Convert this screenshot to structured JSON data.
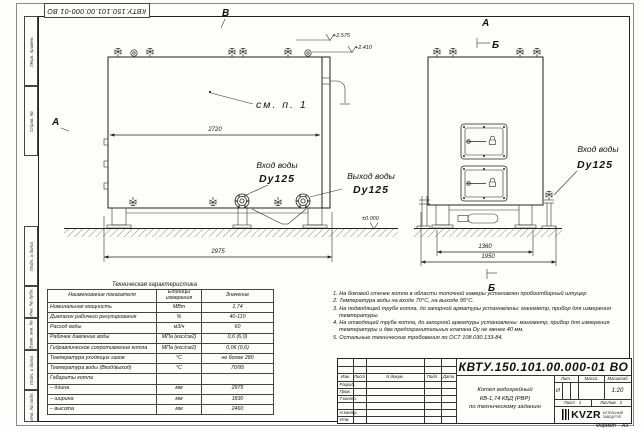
{
  "sheet": {
    "top_stamp": "КВТУ.150.101.00.000-01 ВО",
    "format_label": "Формат",
    "format_value": "А3"
  },
  "margin": {
    "fields": [
      "Перв. примен.",
      "Справ. №",
      "Подп. и дата",
      "Инв. № дубл.",
      "Взам. инв. №",
      "Подп. и дата",
      "Инв. № подл."
    ]
  },
  "views": {
    "front": {
      "mark_top": "В",
      "mark_left": "А",
      "see_note": "см. п. 1",
      "dim_width": "2720",
      "dim_length": "2975",
      "elev1": "+2.575",
      "elev2": "+2.410",
      "elev0": "±0.000",
      "inlet_label": "Вход воды",
      "inlet_dn": "Dy125",
      "outlet_label": "Выход воды",
      "outlet_dn": "Dy125"
    },
    "side": {
      "mark_top": "А",
      "mark_section": "Б",
      "mark_bottom": "Б",
      "dim_inner": "1360",
      "dim_outer": "1950",
      "inlet_label": "Вход воды",
      "inlet_dn": "Dy125"
    }
  },
  "spec_table": {
    "title": "Техническая характеристика",
    "headers": [
      "Наименование показателя",
      "Единицы измерения",
      "Значение"
    ],
    "rows": [
      {
        "name": "Номинальная мощность",
        "unit": "МВт",
        "value": "1,74"
      },
      {
        "name": "Диапазон рабочего регулирования",
        "unit": "%",
        "value": "40-110"
      },
      {
        "name": "Расход воды",
        "unit": "м3/ч",
        "value": "60"
      },
      {
        "name": "Рабочее давление воды",
        "unit": "МПа (кгс/см2)",
        "value": "0,6 (6,0)"
      },
      {
        "name": "Гидравлическое сопротивление котла",
        "unit": "МПа (кгс/см2)",
        "value": "0,06 (0,6)"
      },
      {
        "name": "Температура уходящих газов",
        "unit": "°С",
        "value": "не более 280"
      },
      {
        "name": "Температура воды (Вход/выход)",
        "unit": "°С",
        "value": "70/95"
      },
      {
        "name": "Габариты котла",
        "unit": "",
        "value": ""
      },
      {
        "name": "– длина",
        "unit": "мм",
        "value": "2975"
      },
      {
        "name": "– ширина",
        "unit": "мм",
        "value": "1830"
      },
      {
        "name": "– высота",
        "unit": "мм",
        "value": "2460"
      }
    ]
  },
  "notes": [
    "1. На боковой стенке котла в области топочной камеры установлен пробоотборный штуцер",
    "2. Температура воды на входе 70°С, на выходе 95°С.",
    "3. На подводящей трубе котла, до запорной арматуры установлены: манометр, прибор для измерения температуры.",
    "4. На отводящей трубе котла, до запорной арматуры установлены: манометр, прибор для измерения температуры и два предохранительных клапана Dу не менее 40 мм.",
    "5. Остальные технические требования по ОСТ 108.030.133-84."
  ],
  "title_block": {
    "doc_number": "КВТУ.150.101.00.000-01 ВО",
    "columns": [
      "Изм.",
      "Лист",
      "N докум.",
      "Подп.",
      "Дата"
    ],
    "row_labels": [
      "Разраб.",
      "Пров.",
      "Т.контр.",
      "",
      "Н.контр.",
      "Утв."
    ],
    "product_line1": "Котел водогрейный",
    "product_line2": "КВ-1,74 КБД (РВР)",
    "product_line3": "по техническому заданию",
    "lit_label": "Лит.",
    "mass_label": "Масса",
    "scale_label": "Масштаб",
    "lit_value": "И",
    "scale_value": "1:20",
    "sheet_label": "Лист",
    "sheet_value": "1",
    "sheets_label": "Листов",
    "sheets_value": "2",
    "logo_text": "KVZR",
    "company_line1": "КОТЕЛЬНЫЙ",
    "company_line2": "ЗАВОД РЭП"
  }
}
